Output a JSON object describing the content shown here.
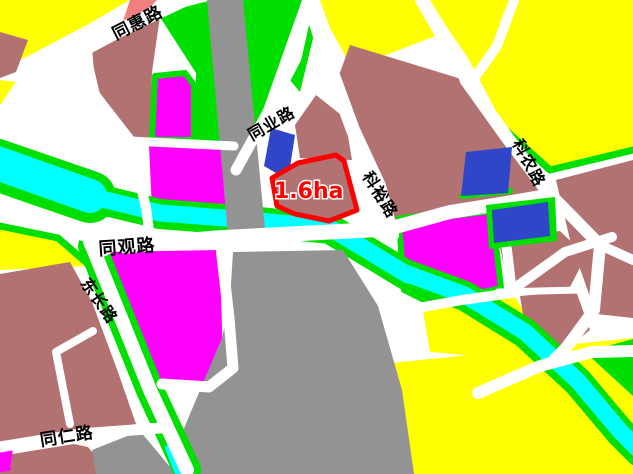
{
  "map": {
    "roads": [
      {
        "id": "tonghui",
        "name": "同惠路"
      },
      {
        "id": "tongye",
        "name": "同业路"
      },
      {
        "id": "keyu",
        "name": "科裕路"
      },
      {
        "id": "kenong",
        "name": "科农路"
      },
      {
        "id": "tongguan",
        "name": "同观路"
      },
      {
        "id": "dongchang",
        "name": "东长路"
      },
      {
        "id": "tongren",
        "name": "同仁路"
      }
    ],
    "area": {
      "label": "1.6ha",
      "size_ha": 1.6
    },
    "colors": {
      "yellow": "#FFFF00",
      "green": "#00DF00",
      "brown": "#B27272",
      "magenta": "#FF00FF",
      "cyan": "#00FFFF",
      "gray": "#939393",
      "blue": "#2F46C8",
      "salmon": "#F08080",
      "red": "#FF0000",
      "white": "#FFFFFF",
      "black": "#000000"
    }
  }
}
